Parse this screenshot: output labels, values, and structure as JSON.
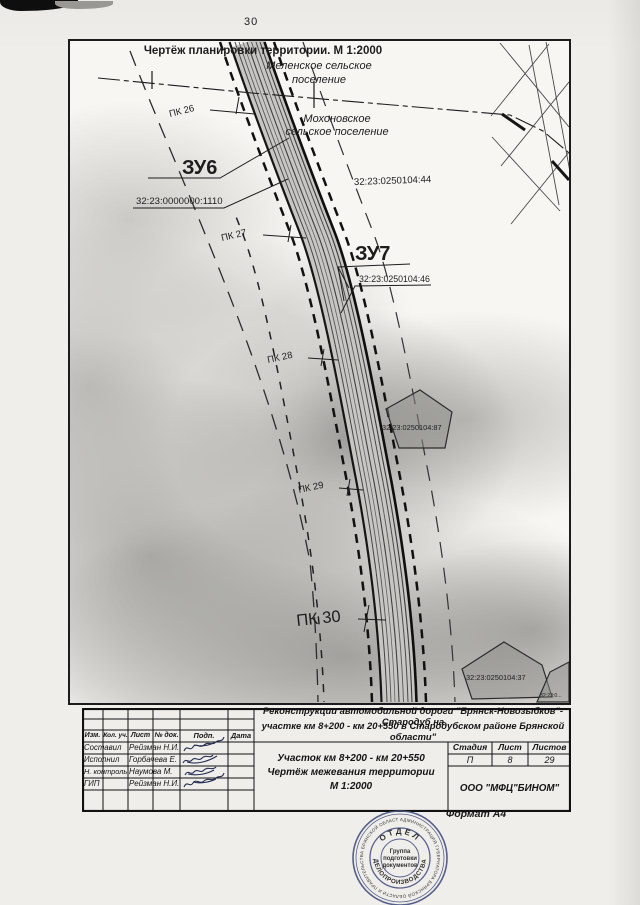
{
  "page": {
    "number": "30",
    "format_label": "Формат А4"
  },
  "map": {
    "title": "Чертёж планировки территории. М 1:2000",
    "settlement_top": {
      "line1": "Меленское сельское",
      "line2": "поселение"
    },
    "settlement_bottom": {
      "line1": "Мохоновское",
      "line2": "сельское поселение"
    },
    "parcels": {
      "zu6_label": "ЗУ6",
      "zu6_cadastral": "32:23:0000000:1110",
      "zu7_label": "ЗУ7",
      "zu7_cadastral": "32:23:0250104:46",
      "right_cadastral": "32:23:0250104:44",
      "pentagon_upper": "32:23:0250104:87",
      "pentagon_lower": "32:23:0250104:37",
      "corner_partial": "32:23:0..."
    },
    "pk_markers": [
      {
        "label": "ПК 26"
      },
      {
        "label": "ПК 27"
      },
      {
        "label": "ПК 28"
      },
      {
        "label": "ПК 29"
      },
      {
        "label": "ПК 30"
      }
    ]
  },
  "title_block": {
    "project_line1": "Реконструкции автомобильной дороги \"Брянск-Новозыбков\"-Стародуб на",
    "project_line2": "участке км 8+200 - км 20+550 в Стародубском районе Брянской области\"",
    "doc_line1": "Участок км 8+200 - км 20+550",
    "doc_line2": "Чертёж межевания территории",
    "doc_line3": "М 1:2000",
    "headers": {
      "izm": "Изм.",
      "kol": "Кол. уч.",
      "list": "Лист",
      "ndok": "№ док.",
      "podp": "Подп.",
      "data": "Дата"
    },
    "rows": [
      {
        "role": "Составил",
        "name": "Рейзман Н.И."
      },
      {
        "role": "Исполнил",
        "name": "Горбачева Е."
      },
      {
        "role": "Н. контроль",
        "name": "Наумова М."
      },
      {
        "role": "ГИП",
        "name": "Рейзман Н.И."
      }
    ],
    "stage_header": "Стадия",
    "stage_value": "П",
    "sheet_header": "Лист",
    "sheet_value": "8",
    "sheets_header": "Листов",
    "sheets_value": "29",
    "company": "ООО \"МФЦ\"БИНОМ\""
  },
  "stamp": {
    "outer_ring": "АДМИНИСТРАЦИЯ ГУБЕРНАТОРА БРЯНСКОЙ ОБЛАСТИ И ПРАВИТЕЛЬСТВА БРЯНСКОЙ ОБЛАСТИ •",
    "ring_top": "ОТДЕЛ",
    "ring_bottom": "ДЕЛОПРОИЗВОДСТВА",
    "center_line1": "Группа",
    "center_line2": "подготовки",
    "center_line3": "документов"
  }
}
